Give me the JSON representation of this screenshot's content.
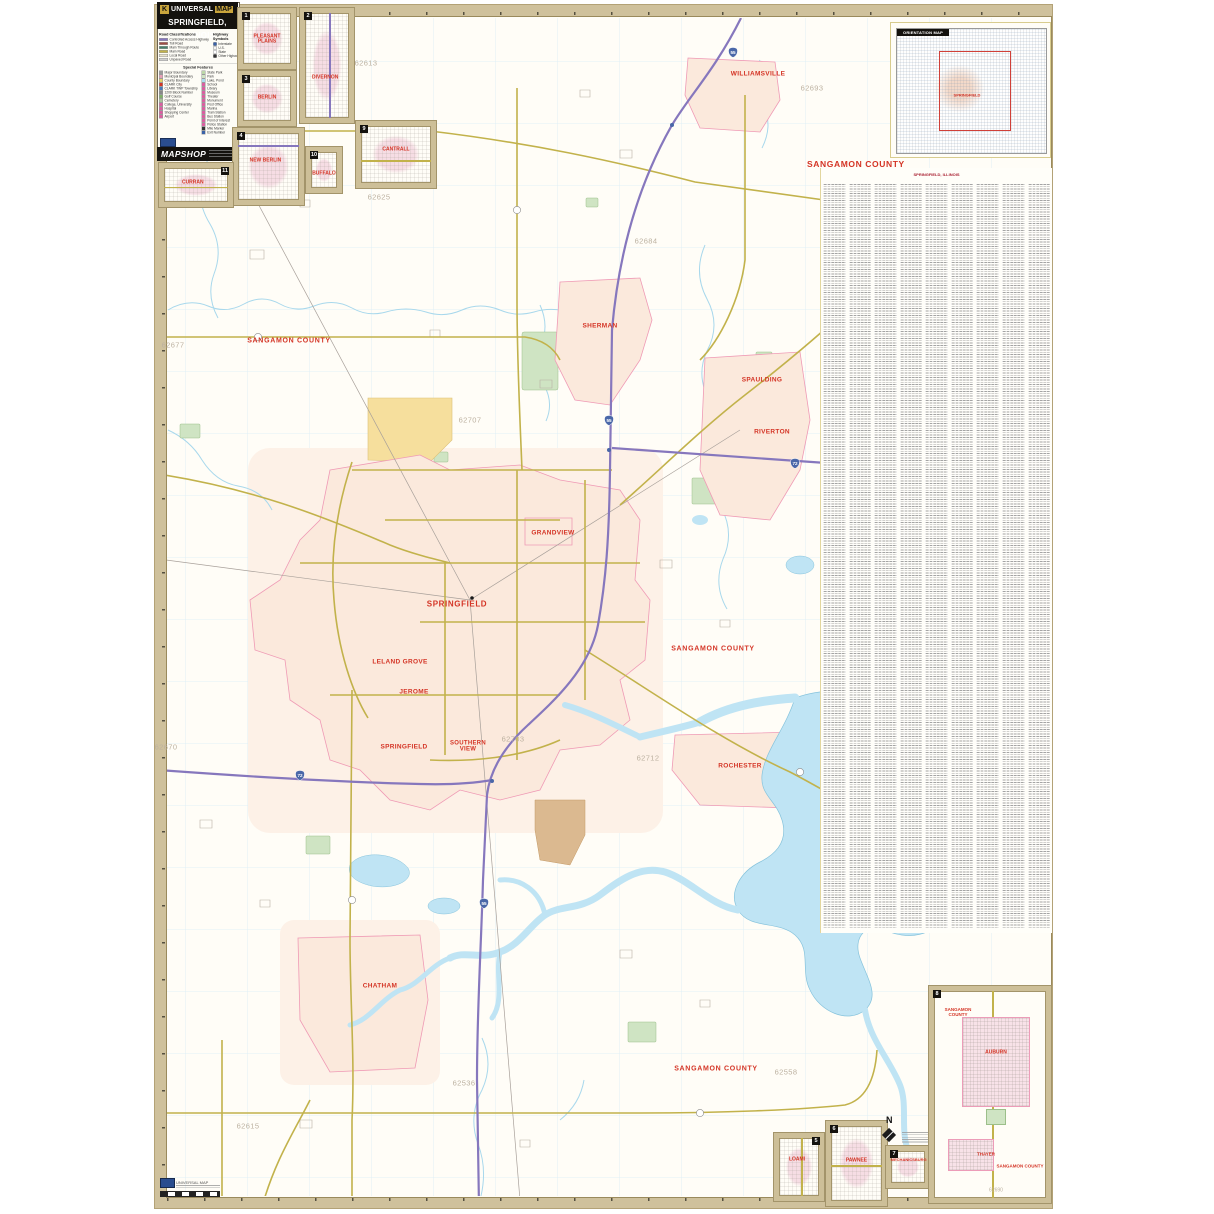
{
  "colors": {
    "town_label": "#d43425",
    "zip_label": "#bcb1a0",
    "interstate": "#8677bd",
    "major_road": "#c2b24b",
    "water": "#bfe4f4",
    "urban_fill": "#fbe9dc",
    "sheet_frame": "#cfc19c"
  },
  "legend": {
    "brand_initial": "K",
    "brand_name": "UNIVERSAL",
    "brand_map": "MAP",
    "title": "SPRINGFIELD, ILLINOIS",
    "section_road": "Road Classifications",
    "section_hwy": "Highway Symbols",
    "section_special": "Special Features",
    "road_classes": [
      {
        "label": "Controlled Access Highway",
        "color": "#8677bd"
      },
      {
        "label": "Toll Road",
        "color": "#9e4d44"
      },
      {
        "label": "Main Through Route",
        "color": "#47806a"
      },
      {
        "label": "Main Road",
        "color": "#c2b24b"
      },
      {
        "label": "Local Road",
        "color": "#e9e4cf"
      },
      {
        "label": "Unpaved Road",
        "color": "#cfcfcf"
      }
    ],
    "hwy_symbols": [
      {
        "label": "Interstate",
        "color": "#3a62a8"
      },
      {
        "label": "U.S.",
        "color": "#f4f4f4"
      },
      {
        "label": "State",
        "color": "#ffffff"
      },
      {
        "label": "Other Highway",
        "color": "#333333"
      }
    ],
    "special_left": [
      {
        "label": "Major Boundary",
        "color": "#9a9a9a"
      },
      {
        "label": "Municipal Boundary",
        "color": "#e8a0b8"
      },
      {
        "label": "County Boundary",
        "color": "#e3d26a"
      },
      {
        "label": "CLARK  City",
        "color": "#d43425"
      },
      {
        "label": "CLARK TWP  Township",
        "color": "#4a7ab8"
      },
      {
        "label": "1200  Block Number",
        "color": "#888888"
      },
      {
        "label": "Golf Course",
        "color": "#7fb069"
      },
      {
        "label": "Cemetery",
        "color": "#a9c29a"
      },
      {
        "label": "College, University",
        "color": "#d95fa0"
      },
      {
        "label": "Hospital",
        "color": "#d95fa0"
      },
      {
        "label": "Shopping Center",
        "color": "#d95fa0"
      },
      {
        "label": "Airport",
        "color": "#d95fa0"
      }
    ],
    "special_right": [
      {
        "label": "State Park",
        "color": "#bcd8a8"
      },
      {
        "label": "Park",
        "color": "#cfe4c3"
      },
      {
        "label": "Lake, Pond",
        "color": "#aadcf0"
      },
      {
        "label": "School",
        "color": "#d95fa0"
      },
      {
        "label": "Library",
        "color": "#d95fa0"
      },
      {
        "label": "Museum",
        "color": "#d95fa0"
      },
      {
        "label": "Theater",
        "color": "#d95fa0"
      },
      {
        "label": "Monument",
        "color": "#d95fa0"
      },
      {
        "label": "Post Office",
        "color": "#d95fa0"
      },
      {
        "label": "Marina",
        "color": "#d95fa0"
      },
      {
        "label": "Train Station",
        "color": "#d95fa0"
      },
      {
        "label": "Bus Station",
        "color": "#d95fa0"
      },
      {
        "label": "Point of Interest",
        "color": "#d95fa0"
      },
      {
        "label": "Police Station",
        "color": "#d95fa0"
      },
      {
        "label": "Mile Marker",
        "color": "#333333"
      },
      {
        "label": "Exit Number",
        "color": "#3a62a8"
      }
    ],
    "mapshop": "MAPSHOP"
  },
  "index_panel": {
    "title": "SANGAMON COUNTY",
    "subtitle": "SPRINGFIELD, ILLINOIS",
    "columns": 9
  },
  "orientation": {
    "title": "ORIENTATION MAP",
    "center_label": "SPRINGFIELD"
  },
  "map": {
    "county": "SANGAMON COUNTY",
    "towns": {
      "williamsville": "WILLIAMSVILLE",
      "sherman": "SHERMAN",
      "spaulding": "SPAULDING",
      "riverton": "RIVERTON",
      "grandview": "GRANDVIEW",
      "springfield": "SPRINGFIELD",
      "leland_grove": "LELAND GROVE",
      "jerome": "JEROME",
      "springfield_s": "SPRINGFIELD",
      "southern_view": "SOUTHERN VIEW",
      "rochester": "ROCHESTER",
      "chatham": "CHATHAM"
    },
    "zips": {
      "z1": "62613",
      "z2": "62625",
      "z3": "62677",
      "z4": "62684",
      "z5": "62693",
      "z6": "62670",
      "z7": "62703",
      "z8": "62712",
      "z9": "62536",
      "z10": "62558",
      "z11": "62615",
      "z12": "62707"
    },
    "shields": {
      "i55": "55",
      "i72": "72"
    }
  },
  "insets": {
    "pleasant_plains": {
      "num": "1",
      "label": "PLEASANT PLAINS"
    },
    "divernon": {
      "num": "2",
      "label": "DIVERNON"
    },
    "berlin": {
      "num": "3",
      "label": "BERLIN"
    },
    "new_berlin": {
      "num": "4",
      "label": "NEW BERLIN"
    },
    "loami": {
      "num": "5",
      "label": "LOAMI"
    },
    "pawnee": {
      "num": "6",
      "label": "PAWNEE"
    },
    "mechanicsburg": {
      "num": "7",
      "label": "MECHANICSBURG"
    },
    "auburn": {
      "num": "8",
      "label": "AUBURN",
      "county_nw": "SANGAMON COUNTY",
      "thayer": "THAYER",
      "county_se": "SANGAMON COUNTY",
      "zip": "62690"
    },
    "cantrall": {
      "num": "9",
      "label": "CANTRALL"
    },
    "buffalo": {
      "num": "10",
      "label": "BUFFALO"
    },
    "curran": {
      "num": "11",
      "label": "CURRAN"
    }
  },
  "compass": {
    "north": "N"
  },
  "footer_logo": {
    "brand": "UNIVERSAL MAP"
  }
}
